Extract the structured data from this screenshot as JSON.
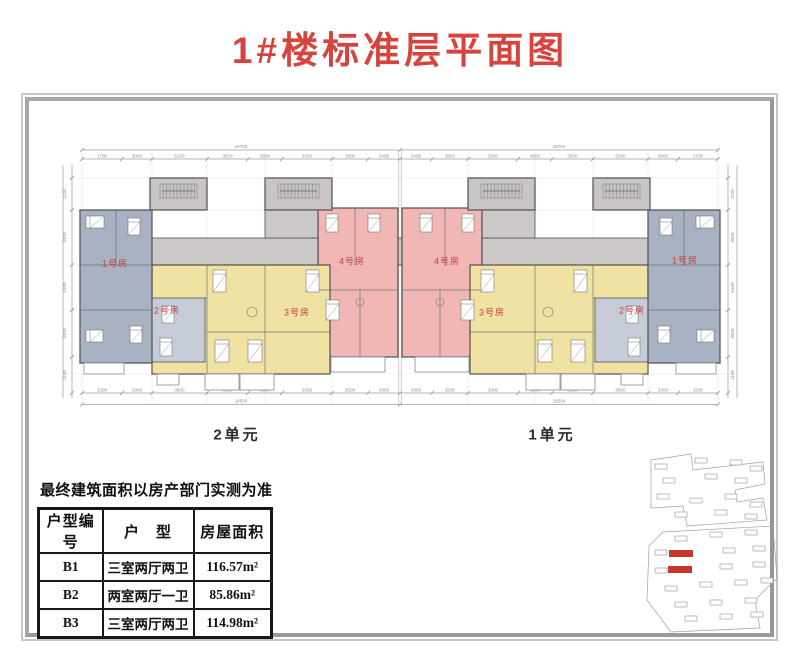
{
  "title": "1#楼标准层平面图",
  "note": "最终建筑面积以房产部门实测为准",
  "sections": {
    "left_unit": "2单元",
    "right_unit": "1单元"
  },
  "plan": {
    "room_labels": [
      "1号房",
      "2号房",
      "3号房",
      "4号房",
      "4号房",
      "3号房",
      "2号房",
      "1号房"
    ]
  },
  "dimensions": {
    "top_total": "28700",
    "bottom_total": "28500",
    "top_segments": [
      "1700",
      "3000",
      "5200",
      "3500",
      "3600",
      "3300",
      "3800",
      "2400"
    ],
    "bottom_segments": [
      "1500",
      "3300",
      "3600",
      "3100",
      "3600",
      "3300",
      "3500",
      "2800"
    ],
    "side_segments": [
      "1100",
      "3300",
      "5100",
      "3300",
      "1100"
    ]
  },
  "table": {
    "headers": [
      "户型编号",
      "户　型",
      "房屋面积"
    ],
    "rows": [
      {
        "code": "B1",
        "type": "三室两厅两卫",
        "area": "116.57m²"
      },
      {
        "code": "B2",
        "type": "两室两厅一卫",
        "area": "85.86m²"
      },
      {
        "code": "B3",
        "type": "三室两厅两卫",
        "area": "114.98m²"
      }
    ]
  },
  "colors": {
    "title_red": "#d5453e",
    "label_red": "#c04545",
    "unit_blue": "#a8b2c3",
    "unit_blue_light": "#c6cdd9",
    "unit_yellow": "#f0e2a3",
    "unit_pink": "#f1b7b5",
    "core_gray": "#c9c5c5",
    "corridor_gray": "#cdc9c9",
    "wall": "#4f4f4f",
    "highlight_red": "#c0392b"
  }
}
